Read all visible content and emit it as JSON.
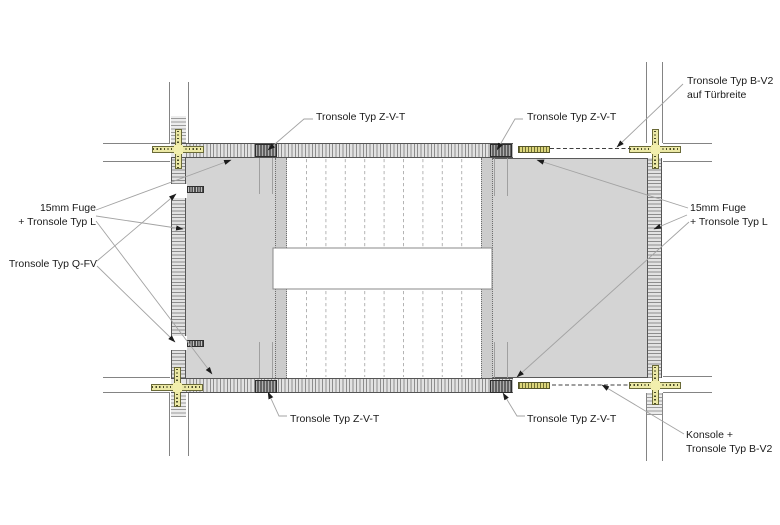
{
  "labels": {
    "tronsole_zvt": "Tronsole Typ Z-V-T",
    "bv2_top_line1": "Tronsole Typ B-V2",
    "bv2_top_line2": "auf Türbreite",
    "fuge_line1": "15mm Fuge",
    "fuge_line2": "+ Tronsole Typ L",
    "qfv": "Tronsole Typ Q-FV",
    "konsole_line1": "Konsole +",
    "konsole_line2": "Tronsole Typ B-V2"
  },
  "colors": {
    "landing_fill": "#d4d4d4",
    "wall_fill": "#e2e2e2",
    "hatch_line": "#8d8d8d",
    "tronsole_dark": "#636363",
    "qfv_dark": "#4f4f4f",
    "joint_marker_yellow": "#ece9a6",
    "bv2_strip_yellow": "#dcd67c",
    "leader_line": "#a3a3a3",
    "text": "#1a1a1a",
    "background": "#ffffff"
  }
}
